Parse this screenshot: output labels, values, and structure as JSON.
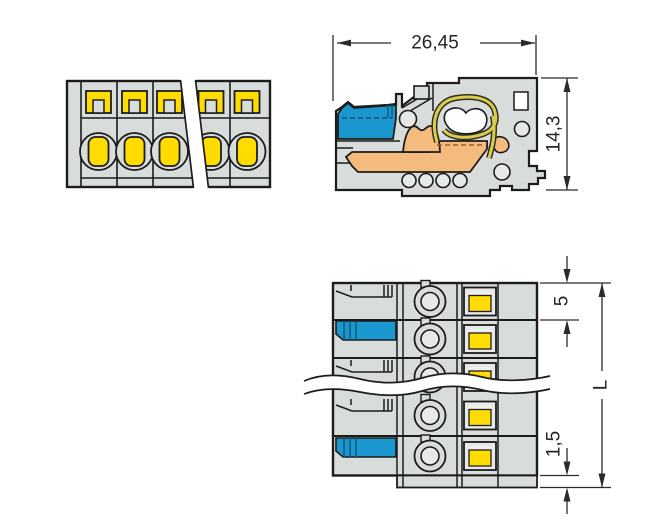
{
  "diagram": {
    "kind": "connector-technical-drawing",
    "dimensions": {
      "overall_width_mm": "26,45",
      "overall_height_mm": "14,3",
      "pole_pitch_mm": "5",
      "total_length": "L",
      "end_offset_mm": "1,5"
    },
    "views": {
      "front_view_poles_visible": 5,
      "top_view_rows_visible": 5
    },
    "colors": {
      "housing_gray": "#d8dcdb",
      "inner_gray": "#e6e9e8",
      "push_button_yellow": "#ffdc00",
      "lever_blue": "#1b97d0",
      "contact_orange": "#f5ba7d",
      "clamp_spring_yellow": "#d9cc4f",
      "outline": "#1c1c1c"
    }
  }
}
